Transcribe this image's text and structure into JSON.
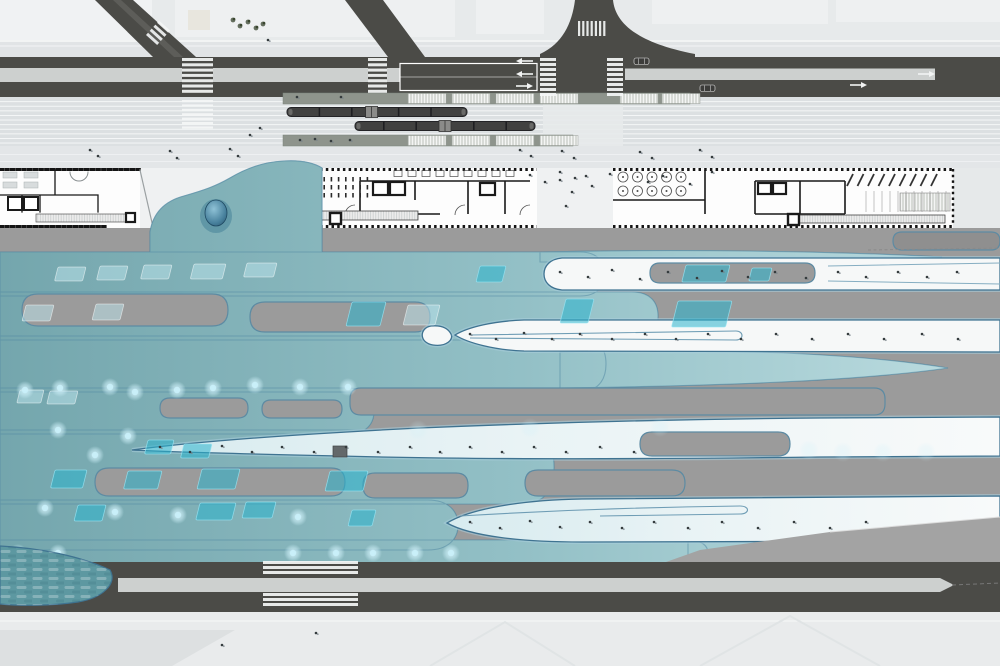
{
  "scene": {
    "type": "architectural-site-plan",
    "description": "Master plan: boulevard with tram corridor, building floor plans, flowing canopy plaza field, secondary road"
  },
  "palette": {
    "base_light": "#e7eaeb",
    "parcel": "#f0f2f3",
    "road_dark": "#4b4b47",
    "median": "#cdd0cf",
    "corridor": "#dce0e2",
    "platform": "#8e948c",
    "platform_hatch": "#d7dad6",
    "tram": "#414140",
    "building_bg": "#ffffff",
    "wall": "#1a1a1a",
    "gray_field": "#9b9b9b",
    "canopy_teal_dark": "#74a6ad",
    "canopy_teal_light": "#b9dade",
    "canopy_ice": "#d7ebef",
    "island_white": "#f6f8f8",
    "island_stroke": "#3f7391",
    "skylight": "#2ab2cc",
    "glow": "#c9f0fa",
    "dome": "#274f68",
    "sidewalk": "#e9ebec"
  },
  "transit": {
    "trams": [
      {
        "x": 287,
        "y": 107.5,
        "w": 180,
        "h": 9,
        "joints": [
          0.18,
          0.36,
          0.62,
          0.8
        ],
        "artic": 0.47
      },
      {
        "x": 355,
        "y": 121.5,
        "w": 180,
        "h": 9,
        "joints": [
          0.16,
          0.34,
          0.66,
          0.84
        ],
        "artic": 0.5
      }
    ],
    "platform_hatches_upper": [
      408,
      452,
      496,
      540,
      620,
      662
    ],
    "platform_hatches_lower": [
      408,
      452,
      496,
      540
    ]
  },
  "roads": {
    "crosswalks": [
      {
        "x": 182,
        "y": 58,
        "w": 31,
        "h": 38,
        "o": "h",
        "s": 5.3,
        "b": 3
      },
      {
        "x": 182,
        "y": 100,
        "w": 31,
        "h": 31,
        "o": "h",
        "s": 4.4,
        "b": 2.2
      },
      {
        "x": 368,
        "y": 58,
        "w": 19,
        "h": 38,
        "o": "h",
        "s": 5.3,
        "b": 3
      },
      {
        "x": 540,
        "y": 58,
        "w": 16,
        "h": 38,
        "o": "h",
        "s": 5,
        "b": 3
      },
      {
        "x": 607,
        "y": 58,
        "w": 16,
        "h": 38,
        "o": "h",
        "s": 5,
        "b": 3
      },
      {
        "x": 578,
        "y": 21,
        "w": 31,
        "h": 15,
        "o": "v",
        "s": 4.2,
        "b": 2.2
      },
      {
        "x": 263,
        "y": 561,
        "w": 95,
        "h": 16,
        "o": "h",
        "s": 5,
        "b": 3
      },
      {
        "x": 263,
        "y": 593,
        "w": 95,
        "h": 17,
        "o": "h",
        "s": 5,
        "b": 3
      }
    ],
    "arrows": [
      {
        "x": 516,
        "y": 61,
        "dir": "left"
      },
      {
        "x": 516,
        "y": 74,
        "dir": "left"
      },
      {
        "x": 516,
        "y": 86,
        "dir": "right"
      },
      {
        "x": 850,
        "y": 85,
        "dir": "right"
      },
      {
        "x": 918,
        "y": 74,
        "dir": "right"
      }
    ],
    "cars": [
      {
        "x": 634,
        "y": 58
      },
      {
        "x": 700,
        "y": 85
      }
    ]
  },
  "buildings": {
    "b2_ticks": {
      "rows": [
        177,
        185,
        193
      ],
      "x0": 309,
      "n": 9,
      "step": 7.2,
      "w": 1.6,
      "h": 4.5
    },
    "b2_tables": {
      "y": 170.5,
      "x0": 394,
      "n": 9,
      "step": 14,
      "w": 8,
      "h": 6
    },
    "b3_circles": {
      "x0": 623,
      "y0": 177,
      "cols": 5,
      "rows": 2,
      "dx": 14.5,
      "dy": 14,
      "r": 5
    },
    "b3_parking": {
      "x0": 847,
      "n": 9,
      "step": 10.5,
      "y1": 186,
      "y2": 174,
      "dx": 6
    },
    "b3_grid": {
      "x0": 866,
      "n": 11,
      "step": 8,
      "y1": 191,
      "y2": 212
    }
  },
  "field": {
    "islands": [
      {
        "d": "M562,258 C550,259 544,266 544,274 C544,282 550,289 562,290 L1000,290 L1000,258 Z",
        "f": "w"
      },
      {
        "d": "M431,326 C419,328 419,343 433,345 C447,347 454,339 451,334 C448,328 441,325 431,326 Z",
        "f": "w"
      },
      {
        "d": "M455,335 C468,327 494,321 524,320 L1000,320 L1000,352 L524,351 C494,350 468,343 455,335 Z",
        "f": "w"
      },
      {
        "d": "M132,450 C200,441 300,434 420,428 C560,422 700,419 820,418 L1000,417 L1000,456 L820,457 C660,459 480,460 340,456 C250,454 170,452 132,450 Z",
        "f": "i"
      },
      {
        "d": "M447,523 C470,509 520,500 582,499 L1000,496 L1000,541 L582,542 C520,542 470,536 447,523 Z",
        "f": "i"
      },
      {
        "d": "M16,585 C60,575 125,573 196,585 C125,596 60,597 16,589 Z",
        "f": "i"
      }
    ],
    "gray_gaps": [
      [
        22,
        294,
        206,
        32,
        16
      ],
      [
        250,
        302,
        180,
        30,
        15
      ],
      [
        160,
        398,
        88,
        20,
        10
      ],
      [
        262,
        400,
        80,
        18,
        9
      ],
      [
        350,
        388,
        535,
        27,
        11
      ],
      [
        95,
        468,
        250,
        28,
        14
      ],
      [
        363,
        473,
        105,
        25,
        12
      ],
      [
        525,
        470,
        160,
        26,
        13
      ],
      [
        893,
        232,
        107,
        18,
        9,
        "#8f8f8f"
      ]
    ],
    "gray_inclusions": [
      [
        650,
        263,
        165,
        20,
        10
      ],
      [
        640,
        432,
        150,
        24,
        12
      ]
    ],
    "skylights": [
      [
        480,
        266,
        26,
        16,
        "b"
      ],
      [
        686,
        265,
        44,
        17,
        "b"
      ],
      [
        752,
        268,
        20,
        13,
        "b"
      ],
      [
        58,
        267,
        28,
        14,
        "p"
      ],
      [
        100,
        266,
        28,
        14,
        "p"
      ],
      [
        144,
        265,
        28,
        14,
        "p"
      ],
      [
        194,
        264,
        32,
        15,
        "p"
      ],
      [
        247,
        263,
        30,
        14,
        "p"
      ],
      [
        352,
        302,
        34,
        24,
        "b"
      ],
      [
        566,
        299,
        28,
        24,
        "b"
      ],
      [
        678,
        301,
        54,
        26,
        "b"
      ],
      [
        26,
        305,
        28,
        16,
        "p"
      ],
      [
        96,
        304,
        28,
        16,
        "p"
      ],
      [
        408,
        305,
        32,
        20,
        "p"
      ],
      [
        20,
        390,
        24,
        13,
        "p"
      ],
      [
        50,
        391,
        28,
        13,
        "p"
      ],
      [
        148,
        440,
        26,
        14,
        "b"
      ],
      [
        184,
        444,
        28,
        14,
        "b"
      ],
      [
        55,
        470,
        32,
        18,
        "b"
      ],
      [
        128,
        471,
        34,
        18,
        "b"
      ],
      [
        202,
        469,
        38,
        20,
        "b"
      ],
      [
        330,
        471,
        38,
        20,
        "b"
      ],
      [
        78,
        505,
        28,
        16,
        "b"
      ],
      [
        200,
        503,
        36,
        17,
        "b"
      ],
      [
        246,
        502,
        30,
        16,
        "b"
      ],
      [
        352,
        510,
        24,
        16,
        "b"
      ]
    ],
    "glow_dots": [
      [
        25,
        390
      ],
      [
        60,
        388
      ],
      [
        110,
        387
      ],
      [
        135,
        392
      ],
      [
        177,
        390
      ],
      [
        213,
        388
      ],
      [
        255,
        385
      ],
      [
        300,
        387
      ],
      [
        348,
        387
      ],
      [
        45,
        508
      ],
      [
        115,
        512
      ],
      [
        178,
        515
      ],
      [
        298,
        517
      ],
      [
        95,
        455
      ],
      [
        58,
        430
      ],
      [
        128,
        436
      ],
      [
        18,
        553
      ],
      [
        58,
        553
      ],
      [
        293,
        553
      ],
      [
        336,
        553
      ],
      [
        373,
        553
      ],
      [
        415,
        553
      ],
      [
        451,
        553
      ]
    ],
    "glow_dots_faint": [
      [
        809,
        450
      ],
      [
        843,
        452
      ],
      [
        883,
        452
      ],
      [
        926,
        452
      ],
      [
        418,
        430
      ],
      [
        530,
        428
      ],
      [
        660,
        427
      ]
    ],
    "trees": [
      [
        233,
        20
      ],
      [
        240,
        26
      ],
      [
        248,
        22
      ],
      [
        256,
        28
      ],
      [
        263,
        24
      ]
    ],
    "specks": [
      [
        90,
        150
      ],
      [
        98,
        156
      ],
      [
        170,
        151
      ],
      [
        177,
        158
      ],
      [
        230,
        149
      ],
      [
        238,
        156
      ],
      [
        520,
        150
      ],
      [
        531,
        156
      ],
      [
        562,
        151
      ],
      [
        574,
        158
      ],
      [
        640,
        152
      ],
      [
        652,
        158
      ],
      [
        700,
        150
      ],
      [
        712,
        157
      ],
      [
        300,
        140
      ],
      [
        315,
        139
      ],
      [
        331,
        141
      ],
      [
        350,
        140
      ],
      [
        297,
        97
      ],
      [
        341,
        97
      ],
      [
        530,
        175
      ],
      [
        545,
        182
      ],
      [
        560,
        172
      ],
      [
        575,
        178
      ],
      [
        592,
        186
      ],
      [
        610,
        174
      ],
      [
        648,
        182
      ],
      [
        663,
        176
      ],
      [
        690,
        184
      ],
      [
        712,
        172
      ],
      [
        560,
        180
      ],
      [
        572,
        192
      ],
      [
        586,
        176
      ],
      [
        566,
        206
      ],
      [
        560,
        272
      ],
      [
        588,
        277
      ],
      [
        612,
        270
      ],
      [
        640,
        279
      ],
      [
        668,
        272
      ],
      [
        697,
        278
      ],
      [
        722,
        271
      ],
      [
        748,
        277
      ],
      [
        775,
        272
      ],
      [
        806,
        278
      ],
      [
        838,
        272
      ],
      [
        866,
        277
      ],
      [
        898,
        272
      ],
      [
        927,
        277
      ],
      [
        957,
        272
      ],
      [
        470,
        334
      ],
      [
        496,
        339
      ],
      [
        524,
        333
      ],
      [
        552,
        339
      ],
      [
        580,
        334
      ],
      [
        612,
        339
      ],
      [
        645,
        334
      ],
      [
        676,
        339
      ],
      [
        708,
        334
      ],
      [
        741,
        339
      ],
      [
        776,
        334
      ],
      [
        812,
        339
      ],
      [
        848,
        334
      ],
      [
        884,
        339
      ],
      [
        922,
        334
      ],
      [
        958,
        339
      ],
      [
        160,
        447
      ],
      [
        190,
        452
      ],
      [
        222,
        446
      ],
      [
        252,
        452
      ],
      [
        282,
        447
      ],
      [
        314,
        452
      ],
      [
        346,
        447
      ],
      [
        378,
        452
      ],
      [
        410,
        447
      ],
      [
        440,
        452
      ],
      [
        470,
        447
      ],
      [
        502,
        452
      ],
      [
        534,
        447
      ],
      [
        566,
        452
      ],
      [
        600,
        447
      ],
      [
        634,
        452
      ],
      [
        470,
        522
      ],
      [
        500,
        528
      ],
      [
        530,
        521
      ],
      [
        560,
        527
      ],
      [
        590,
        522
      ],
      [
        622,
        528
      ],
      [
        654,
        522
      ],
      [
        688,
        528
      ],
      [
        722,
        522
      ],
      [
        758,
        528
      ],
      [
        794,
        522
      ],
      [
        830,
        528
      ],
      [
        866,
        522
      ],
      [
        222,
        645
      ],
      [
        316,
        633
      ],
      [
        268,
        40
      ],
      [
        250,
        135
      ],
      [
        260,
        128
      ]
    ]
  }
}
